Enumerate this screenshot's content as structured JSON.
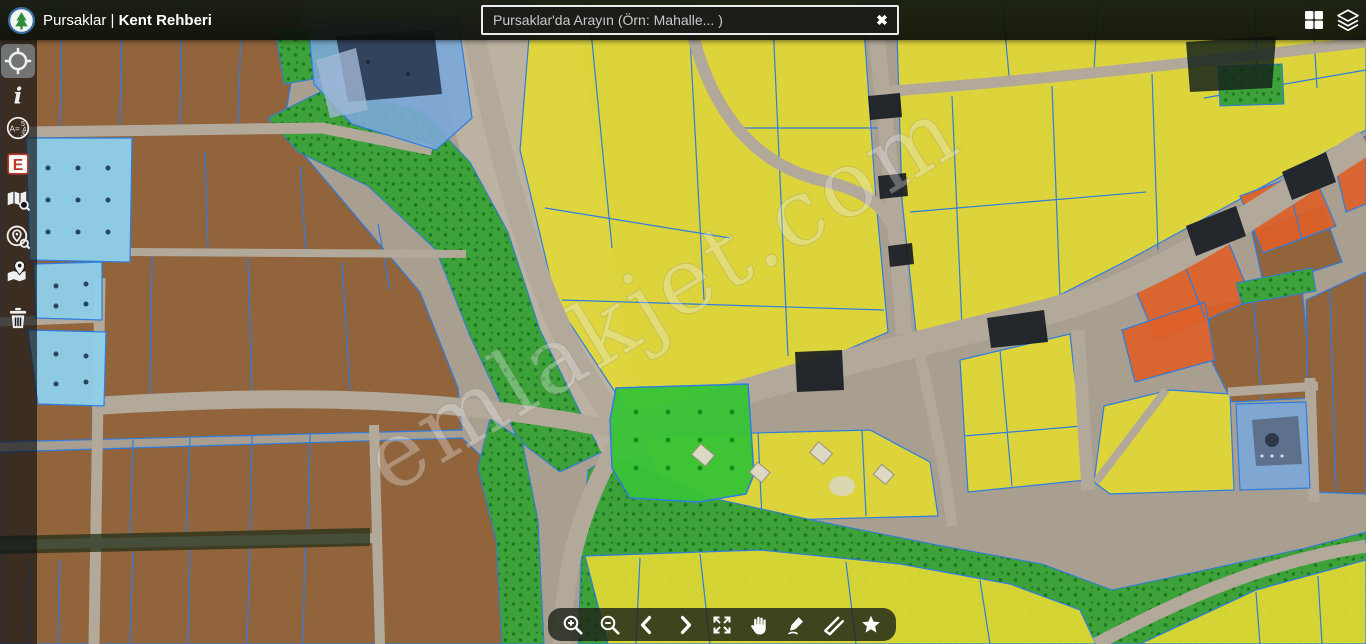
{
  "header": {
    "logo_icon": "pursaklar-municipality-logo",
    "title_prefix": "Pursaklar |",
    "title_bold": "Kent Rehberi",
    "search": {
      "placeholder": "Pursaklar'da Arayın (Örn: Mahalle... )",
      "value": "",
      "clear_glyph": "✖"
    },
    "actions": [
      {
        "name": "basemaps",
        "icon": "grid-apps-icon"
      },
      {
        "name": "layers",
        "icon": "layers-icon"
      }
    ]
  },
  "sidebar": {
    "tools": [
      {
        "name": "locate",
        "icon": "crosshair-icon",
        "active": true
      },
      {
        "name": "info",
        "icon": "info-icon",
        "glyph": "i"
      },
      {
        "name": "parcel-query",
        "icon": "parcel-query-icon",
        "glyph_a": "A=",
        "glyph_top": "5",
        "glyph_mid": "4",
        "glyph_bottom": "3"
      },
      {
        "name": "e-plan",
        "icon": "e-plan-icon",
        "glyph": "E"
      },
      {
        "name": "map-search",
        "icon": "map-search-icon"
      },
      {
        "name": "place-search",
        "icon": "place-search-icon"
      },
      {
        "name": "nearest-places",
        "icon": "map-pin-icon"
      },
      {
        "name": "clear",
        "icon": "trash-icon"
      }
    ]
  },
  "toolbar": {
    "items": [
      {
        "name": "zoom-in",
        "icon": "zoom-in-icon"
      },
      {
        "name": "zoom-out",
        "icon": "zoom-out-icon"
      },
      {
        "name": "previous",
        "icon": "chevron-left-icon"
      },
      {
        "name": "next",
        "icon": "chevron-right-icon"
      },
      {
        "name": "fullscreen",
        "icon": "expand-icon"
      },
      {
        "name": "pan",
        "icon": "hand-icon"
      },
      {
        "name": "draw",
        "icon": "marker-pen-icon"
      },
      {
        "name": "measure",
        "icon": "ruler-icon"
      },
      {
        "name": "favorites",
        "icon": "star-icon"
      }
    ]
  },
  "map": {
    "watermark": "emlakjet.com",
    "colors": {
      "ground": "#a89f90",
      "road_base": "#b2a99a",
      "zone_brown": "#8f5d33",
      "zone_yellow": "#e2d835",
      "zone_green": "#3da23a",
      "zone_field_green": "#38c336",
      "zone_orange": "#dd5f28",
      "zone_blue": "#7aa7d8",
      "zone_cyan": "#8ed0ea",
      "parcel_line": "#2f7de0",
      "shadow_dark": "#141a20"
    }
  }
}
